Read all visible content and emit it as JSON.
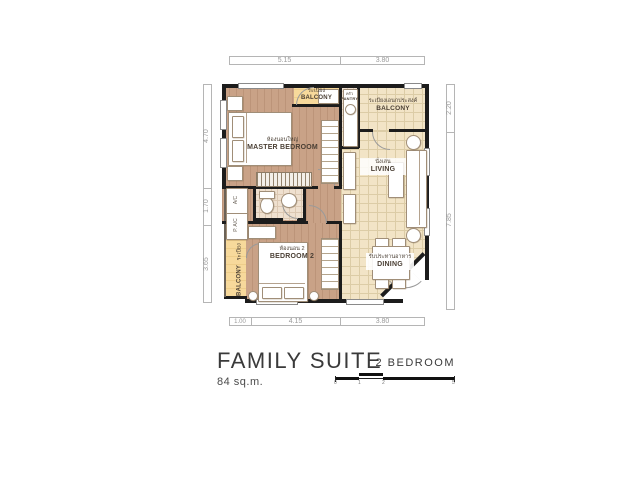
{
  "dimensions": {
    "top": [
      "5.15",
      "3.80"
    ],
    "bottom": [
      "1.00",
      "4.15",
      "3.80"
    ],
    "left": [
      "4.70",
      "1.70",
      "3.65"
    ],
    "right": [
      "2.20",
      "7.85"
    ]
  },
  "rooms": {
    "master_bedroom": {
      "thai": "ห้องนอนใหญ่",
      "label": "MASTER BEDROOM"
    },
    "bedroom2": {
      "thai": "ห้องนอน 2",
      "label": "BEDROOM 2"
    },
    "living": {
      "thai": "นั่งเล่น",
      "label": "LIVING"
    },
    "dining": {
      "thai": "รับประทานอาหาร",
      "label": "DINING"
    },
    "pantry": {
      "thai": "ครัว",
      "label": "PANTRY"
    },
    "balcony_top": {
      "thai": "ระเบียง",
      "label": "BALCONY"
    },
    "balcony_right": {
      "thai": "ระเบียงเอนกประสงค์",
      "label": "BALCONY"
    },
    "balcony_left": {
      "thai": "ระเบียง",
      "label": "BALCONY"
    }
  },
  "equipment": {
    "ac": "A/C",
    "p_ac": "P. A/C"
  },
  "title_block": {
    "title": "FAMILY SUITE",
    "area": "84 sq.m.",
    "unit_type": "2 BEDROOM",
    "scale_ticks": [
      "0",
      "1",
      "2",
      "5"
    ]
  },
  "colors": {
    "wood": "#c9a287",
    "tile": "#f2e4c6",
    "balcony": "#f7d99b",
    "wall": "#1c1c1c"
  }
}
